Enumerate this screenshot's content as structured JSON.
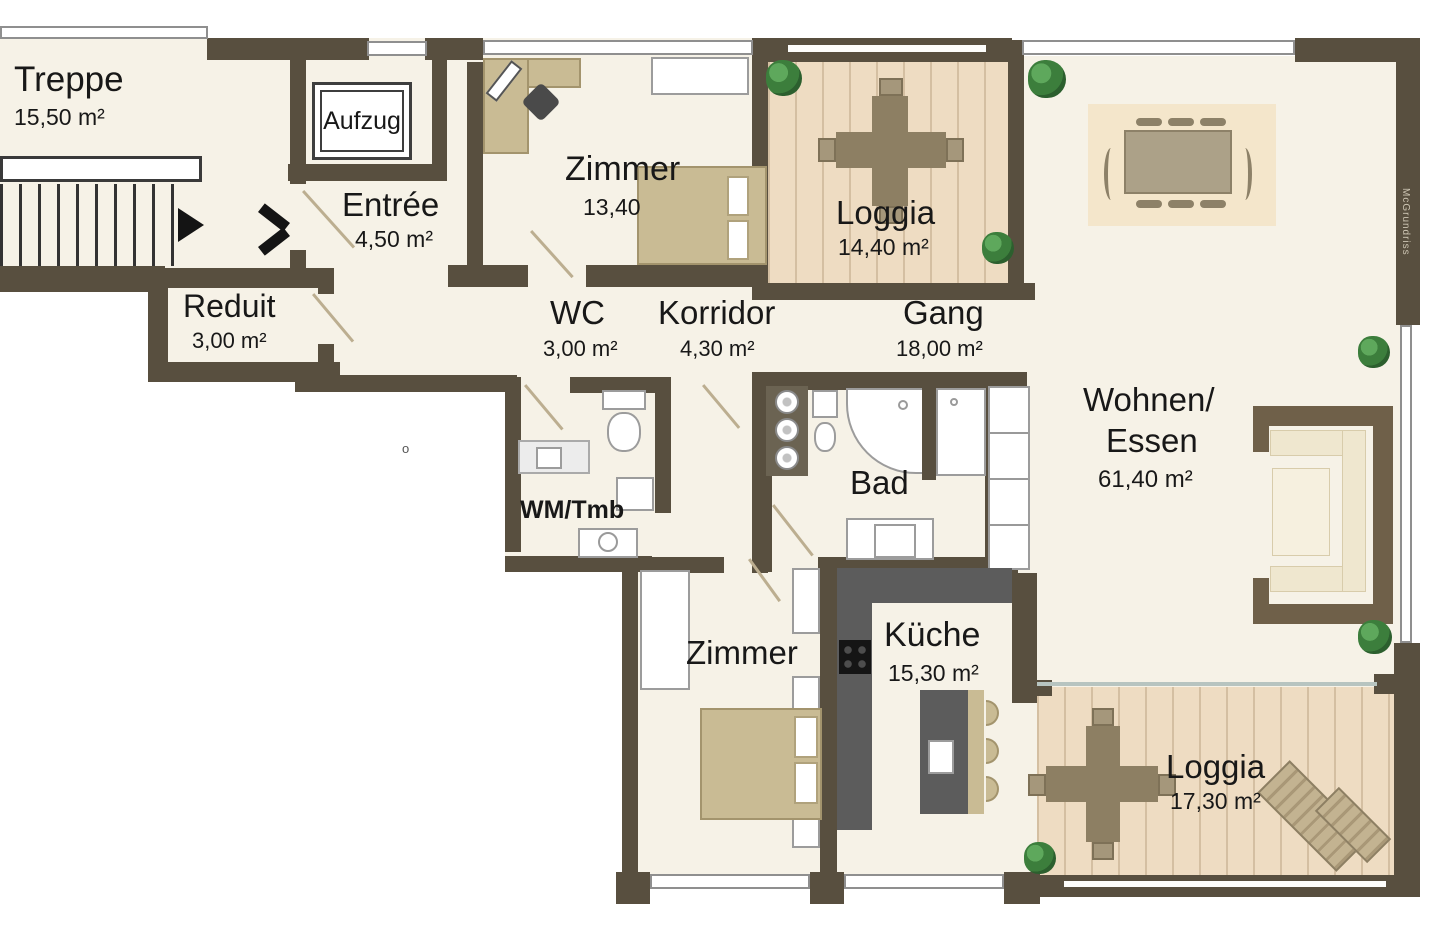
{
  "plan": {
    "watermark": "McGrundriss",
    "stray_mark": "o"
  },
  "colors": {
    "wall": "#584f3f",
    "floor": "#f6f2e7",
    "deck": "#eedcc2",
    "rug": "#f4e6cb",
    "furniture_beige": "#c9bb94",
    "furniture_dark": "#5c5c5c",
    "sofa_frame": "#6f6049",
    "plant_green": "#3c7e3c",
    "text": "#181818"
  },
  "rooms": {
    "treppe": {
      "name": "Treppe",
      "area": "15,50 m²"
    },
    "aufzug": {
      "name": "Aufzug"
    },
    "entree": {
      "name": "Entrée",
      "area": "4,50 m²"
    },
    "zimmer_top": {
      "name": "Zimmer",
      "area": "13,40"
    },
    "loggia_top": {
      "name": "Loggia",
      "area": "14,40 m²"
    },
    "reduit": {
      "name": "Reduit",
      "area": "3,00 m²"
    },
    "wc": {
      "name": "WC",
      "area": "3,00 m²"
    },
    "korridor": {
      "name": "Korridor",
      "area": "4,30 m²"
    },
    "gang": {
      "name": "Gang",
      "area": "18,00 m²"
    },
    "wohnen_essen": {
      "name_line1": "Wohnen/",
      "name_line2": "Essen",
      "area": "61,40 m²"
    },
    "wm_tmb": {
      "name": "WM/Tmb"
    },
    "bad": {
      "name": "Bad"
    },
    "zimmer_bottom": {
      "name": "Zimmer"
    },
    "kueche": {
      "name": "Küche",
      "area": "15,30 m²"
    },
    "loggia_bottom": {
      "name": "Loggia",
      "area": "17,30 m²"
    }
  }
}
